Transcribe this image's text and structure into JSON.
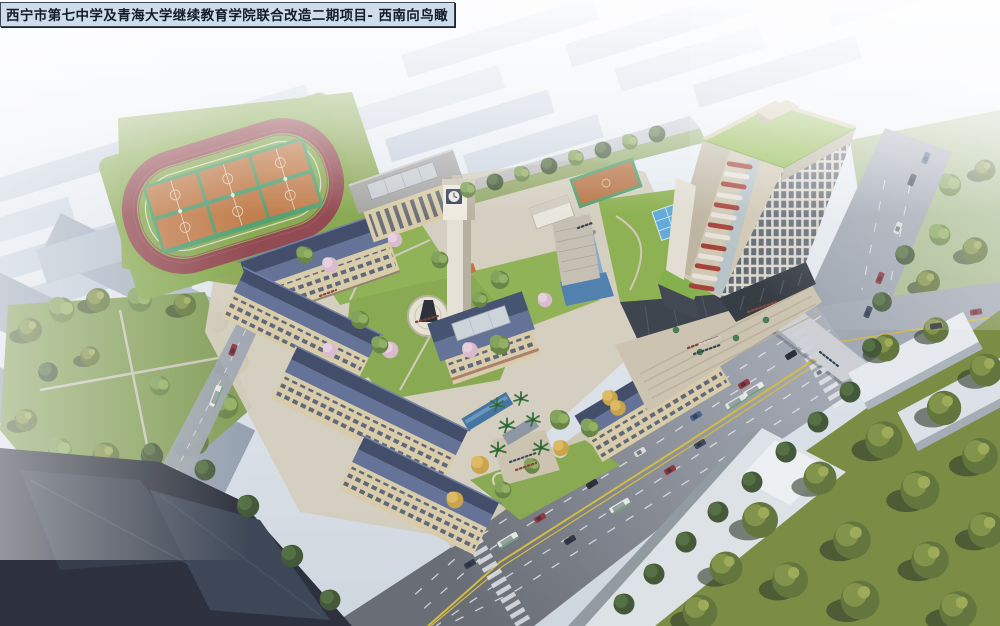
{
  "title_overlay": {
    "text": "西宁市第七中学及青海大学继续教育学院联合改造二期项目- 西南向鸟瞰"
  },
  "scene": {
    "type": "architectural-aerial-rendering",
    "view": "southwest-birdseye",
    "landmarks": {
      "running_track": "red running track with six orange basketball courts",
      "background_field": "small teal sports field in hazy background",
      "school_wings": "cream classroom wings with dark slate pitched roofs around green courtyards",
      "auditorium": "flat-roof hall with glass skylight and columns",
      "clock_tower": "white campus clock tower",
      "central_hall": "hip-roof hall with glass skylight on entrance axis",
      "statue_plaza": "circular plaza with dark statue",
      "entrance_canal": "blue water canal with palm trees at south gate",
      "podium_green_roof": "green roof podium with blue glass skylight and waterfall",
      "highrise_tower": "continuing-education tower, green roof, grid facade, red-white corner balconies",
      "tower_plaza": "stepped plaza with crowds and green umbrellas",
      "main_road": "wide arterial road with yellow centerline, cars and buses",
      "side_road": "north-south road meeting at intersection",
      "west_street": "narrow street west of campus",
      "west_park": "tree-filled park west of campus",
      "southeast_grove": "dense olive tree park across the road",
      "city_background": "hazy white city skyline"
    }
  },
  "palette": {
    "titleBg": "#cfdcec",
    "titleBorder": "#3a4754",
    "titleText": "#101c2a",
    "trackRed": "#8e4349",
    "lawn": "#84a74a",
    "lawnBright": "#8db050",
    "courtOrange": "#c07a46",
    "courtTrim": "#4f9d6d",
    "roofLight": "#5d6d92",
    "roofDark": "#3a4763",
    "wallCream": "#d9cba6",
    "windowDark": "#43506a",
    "towerGreenRoof": "#88b43e",
    "towerFrame": "#cfc6b0",
    "towerRed": "#a23a30",
    "skylightBlue": "#5ba8d8",
    "water": "#3f6f9e",
    "roadGray": "#9aa1ac",
    "laneYellow": "#d2b93a",
    "laneWhite": "#e8eaec",
    "pavement": "#cbc2ac",
    "treeMid": "#63813f",
    "treeDark": "#3c5230",
    "treeOlive": "#5c7033",
    "treeBlossom": "#d9b8cc",
    "treeAutumn": "#c9a144",
    "hazeCity": "#bdc9d7",
    "darkBlock": "#232833",
    "whiteSlab": "#dde2e6"
  }
}
